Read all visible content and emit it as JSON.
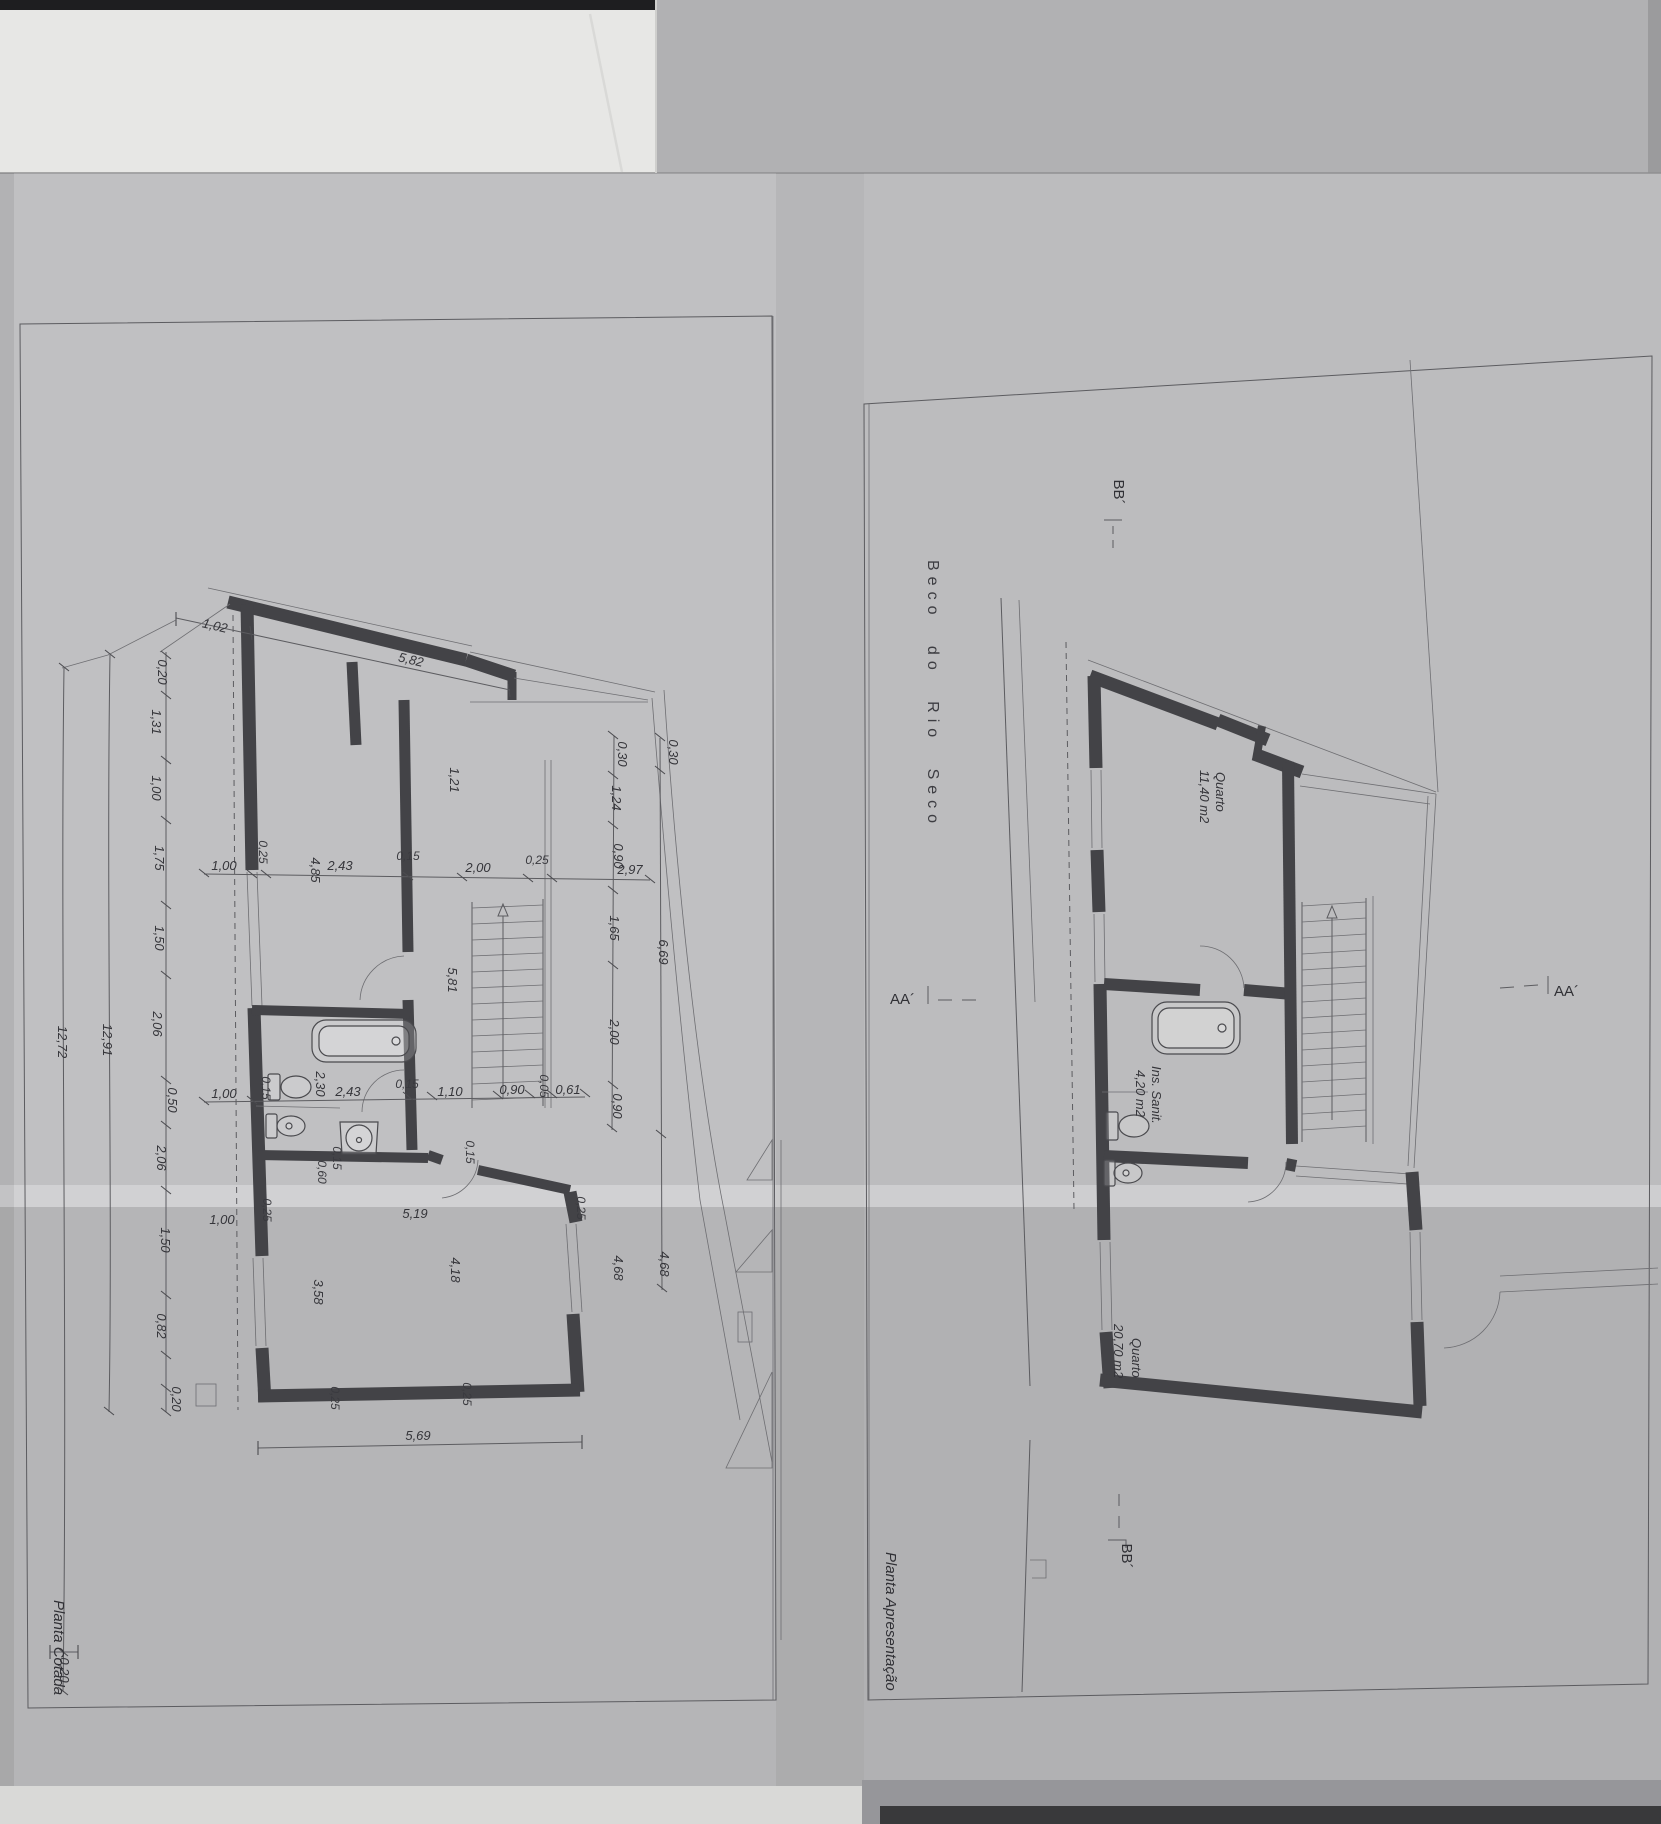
{
  "left_plan": {
    "title": "Planta Cotada",
    "dim_top": [
      "1,02",
      "5,82"
    ],
    "dim_left_chain": [
      "0,20",
      "1,31",
      "1,00",
      "1,75",
      "1,50",
      "2,06",
      "0,50",
      "2,06",
      "1,50",
      "0,82",
      "0,20"
    ],
    "dim_left_totals": [
      "12,72",
      "12,91"
    ],
    "dim_bottom_left": "0,20",
    "dim_row_upper": [
      "1,00",
      "0,25",
      "4,85",
      "2,43",
      "0,15",
      "2,00",
      "0,25",
      "2,97"
    ],
    "dim_row_lower": [
      "1,00",
      "0,15",
      "2,30",
      "2,43",
      "0,15",
      "1,10",
      "0,90",
      "0,05",
      "0,61"
    ],
    "dim_right_chain": [
      "0,30",
      "1,24",
      "0,90",
      "1,65",
      "2,00",
      "0,90"
    ],
    "dim_right_outer": [
      "0,30",
      "6,69",
      "4,68"
    ],
    "dim_inner": [
      "1,21",
      "5,81",
      "0,15",
      "0,60",
      "4,68",
      "0,15"
    ],
    "dim_bottom": [
      "1,00",
      "0,25",
      "5,19",
      "0,25",
      "3,58",
      "4,18",
      "0,25",
      "0,25",
      "5,69"
    ]
  },
  "right_plan": {
    "title": "Planta Apresentação",
    "street": "Beco do Rio Seco",
    "rooms": [
      {
        "name": "Quarto",
        "area": "11,40 m2"
      },
      {
        "name": "Ins. Sanit.",
        "area": "4,20 m2"
      },
      {
        "name": "Quarto",
        "area": "20,70 m2"
      }
    ],
    "marker_aa": "AA´",
    "marker_bb": "BB´"
  }
}
